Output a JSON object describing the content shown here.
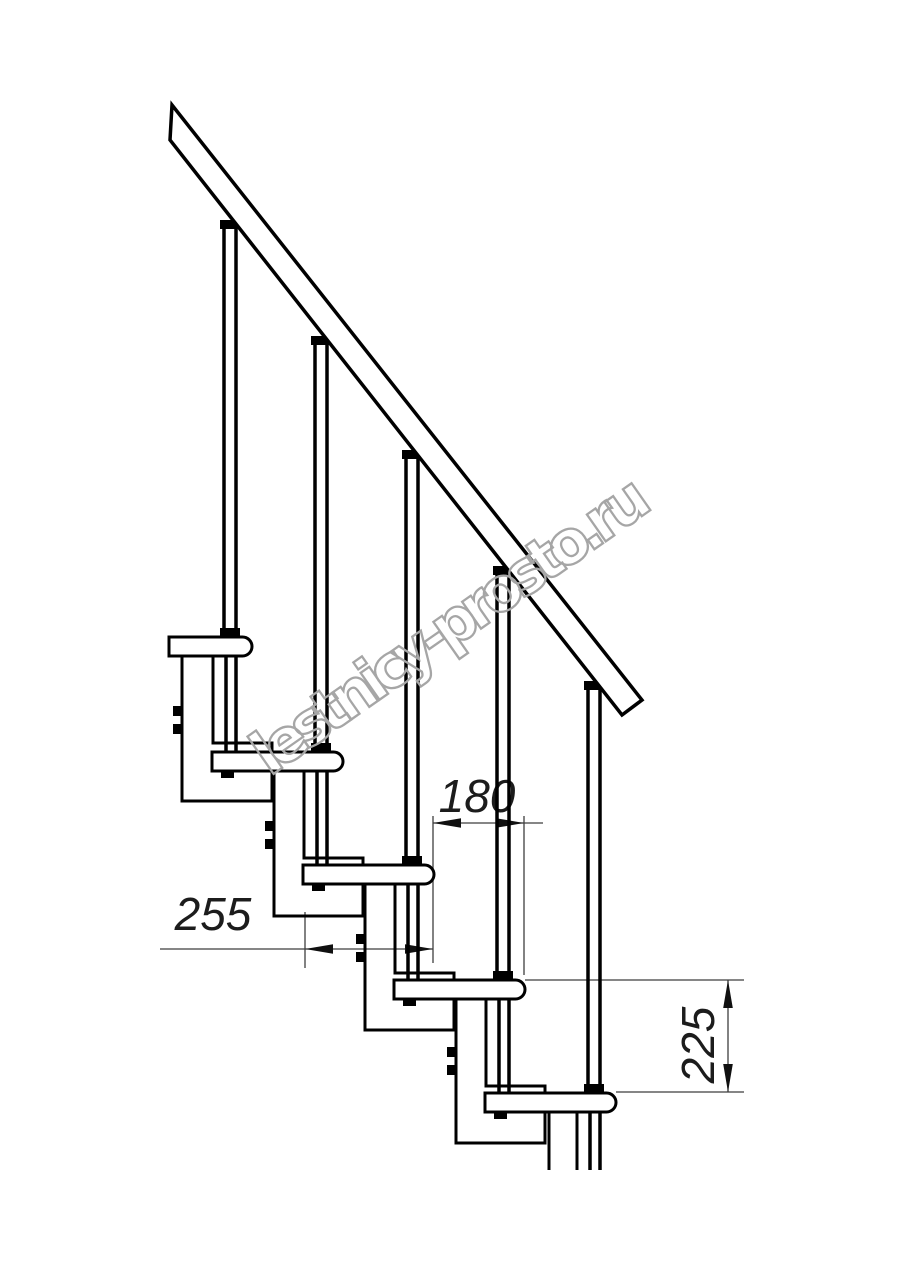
{
  "drawing": {
    "description": "Side-view technical drawing of a modular staircase with handrail and balusters",
    "watermark": {
      "text": "lestnicy-prosto.ru",
      "color": "#a6a6a6"
    },
    "dimensions": {
      "step_run": {
        "value": "180"
      },
      "tread_depth": {
        "value": "255"
      },
      "riser_height": {
        "value": "225"
      }
    },
    "colors": {
      "line": "#000000",
      "dimension_line": "#3f3f3f",
      "background": "#ffffff"
    }
  }
}
